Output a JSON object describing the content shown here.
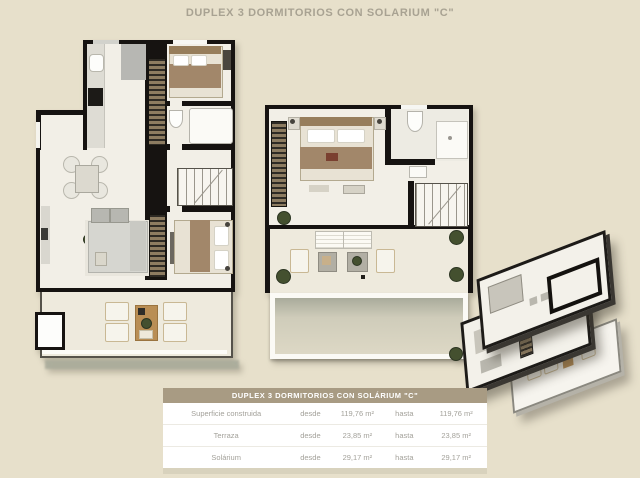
{
  "page": {
    "title": "DUPLEX 3 DORMITORIOS CON SOLARIUM \"C\""
  },
  "table": {
    "header": "DUPLEX 3 DORMITORIOS CON SOLÁRIUM \"C\"",
    "rows": [
      {
        "label": "Superficie construida",
        "from_label": "desde",
        "from_value": "119,76 m²",
        "to_label": "hasta",
        "to_value": "119,76 m²"
      },
      {
        "label": "Terraza",
        "from_label": "desde",
        "from_value": "23,85 m²",
        "to_label": "hasta",
        "to_value": "23,85 m²"
      },
      {
        "label": "Solárium",
        "from_label": "desde",
        "from_value": "29,17 m²",
        "to_label": "hasta",
        "to_value": "29,17 m²"
      }
    ]
  },
  "colors": {
    "bg": "#e7e0cb",
    "wall": "#161311",
    "floor": "#f2efe7",
    "deck": "#eeeadd",
    "shadow": "#a9ab9b",
    "thead": "#a89b83",
    "ttext": "#a3a19a",
    "title": "#a8a292",
    "wood": "#b98e55",
    "green": "#44502f"
  },
  "icons": {
    "plant_pot": "dark-green-circle",
    "stairs": "striped-treads",
    "wardrobe": "striped-rect",
    "stove": "black-rect",
    "sink": "white-rounded-rect"
  }
}
